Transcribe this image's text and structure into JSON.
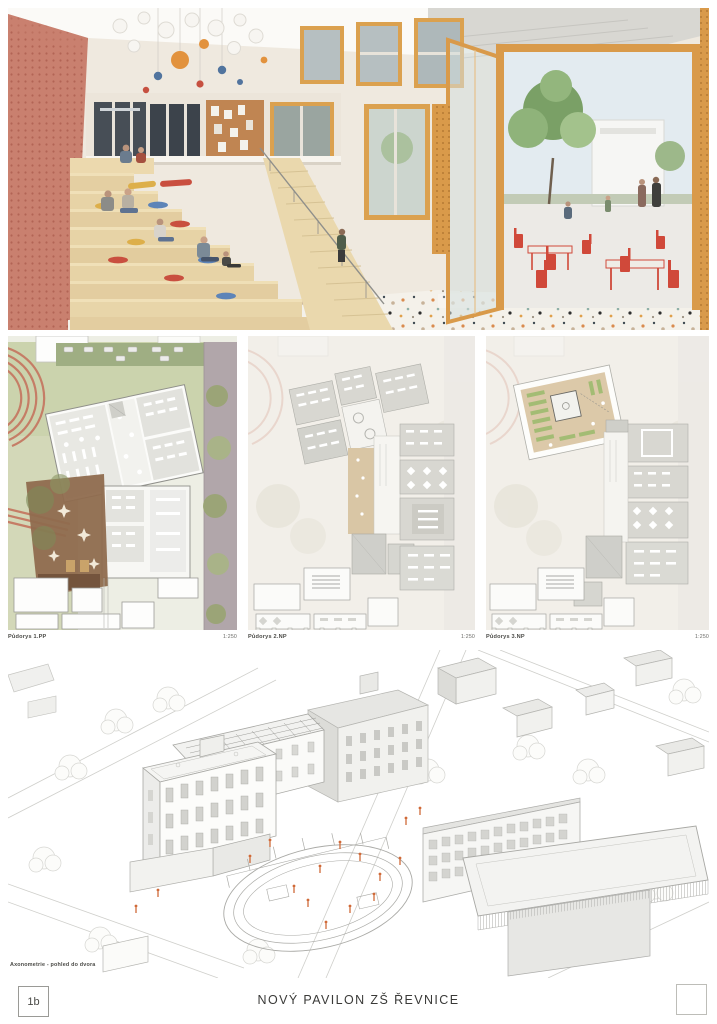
{
  "board": {
    "sheet_number": "1b",
    "title": "NOVÝ PAVILON ZŠ ŘEVNICE"
  },
  "plans": [
    {
      "label": "Půdorys 1.PP",
      "scale": "1:250"
    },
    {
      "label": "Půdorys 2.NP",
      "scale": "1:250"
    },
    {
      "label": "Půdorys 3.NP",
      "scale": "1:250"
    }
  ],
  "axonometric": {
    "caption": "Axonometrie - pohled do dvora"
  },
  "colors": {
    "coral_wall": "#c9806f",
    "wood_steps": "#e6d2a6",
    "window_frame_orange": "#d99a4a",
    "furniture_red": "#d0493a",
    "tree_green": "#7ba269",
    "track_red": "#c57d66",
    "courtyard_brown": "#8d6a4c",
    "roof_garden_green": "#a3bc74",
    "plan_room_gray": "#d8d7d1",
    "axo_line_gray": "#b5b5b5"
  }
}
